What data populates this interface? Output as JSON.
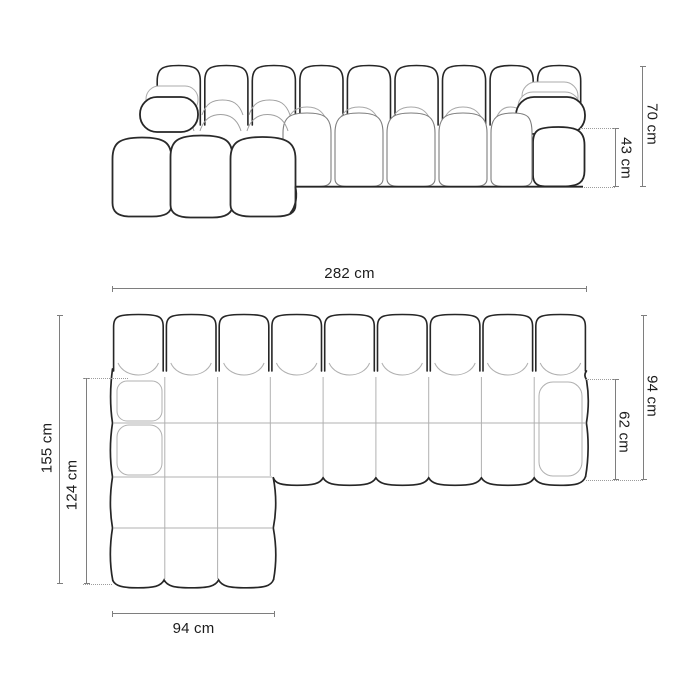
{
  "colors": {
    "outline": "#262626",
    "inner_seam": "#ababab",
    "mid_seam": "#7d7d7d",
    "dimension_line": "#7e7e7e",
    "dotted_line": "#9c9c9c",
    "text": "#1c1c1c",
    "background": "#ffffff"
  },
  "front_view": {
    "dimensions": {
      "total_height": {
        "label": "70 cm",
        "value": 70,
        "unit": "cm"
      },
      "seat_height": {
        "label": "43 cm",
        "value": 43,
        "unit": "cm"
      }
    }
  },
  "top_view": {
    "dimensions": {
      "total_width": {
        "label": "282 cm",
        "value": 282,
        "unit": "cm"
      },
      "body_depth": {
        "label": "94 cm",
        "value": 94,
        "unit": "cm"
      },
      "seat_depth": {
        "label": "62 cm",
        "value": 62,
        "unit": "cm"
      },
      "total_depth": {
        "label": "155 cm",
        "value": 155,
        "unit": "cm"
      },
      "chaise_depth": {
        "label": "124 cm",
        "value": 124,
        "unit": "cm"
      },
      "chaise_width": {
        "label": "94 cm",
        "value": 94,
        "unit": "cm"
      }
    }
  }
}
